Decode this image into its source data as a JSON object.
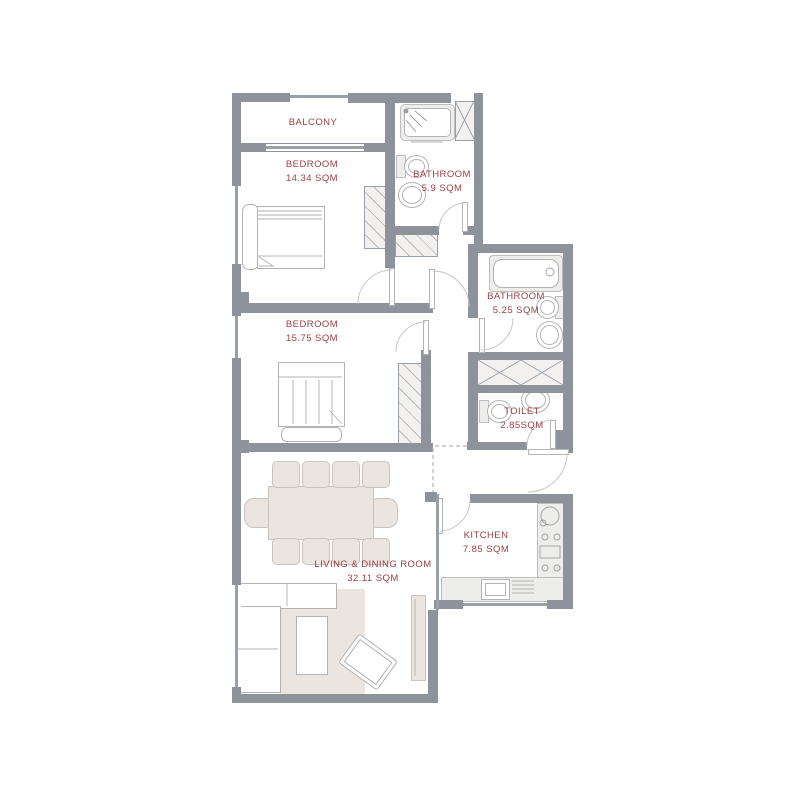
{
  "plan": {
    "type": "apartment-floor-plan"
  },
  "rooms": [
    {
      "name": "BALCONY",
      "area": ""
    },
    {
      "name": "BEDROOM",
      "area": "14.34 SQM"
    },
    {
      "name": "BATHROOM",
      "area": "5.9 SQM"
    },
    {
      "name": "BEDROOM",
      "area": "15.75 SQM"
    },
    {
      "name": "BATHROOM",
      "area": "5.25 SQM"
    },
    {
      "name": "TOILET",
      "area": "2.85SQM"
    },
    {
      "name": "LIVING & DINING ROOM",
      "area": "32.11 SQM"
    },
    {
      "name": "KITCHEN",
      "area": "7.85 SQM"
    }
  ],
  "colors": {
    "wall": "#8e939b",
    "label": "#9c4046",
    "beige": "#eae5e0",
    "lite": "#ededec",
    "line": "#b3b3b3",
    "winline": "#9aa0a8"
  }
}
